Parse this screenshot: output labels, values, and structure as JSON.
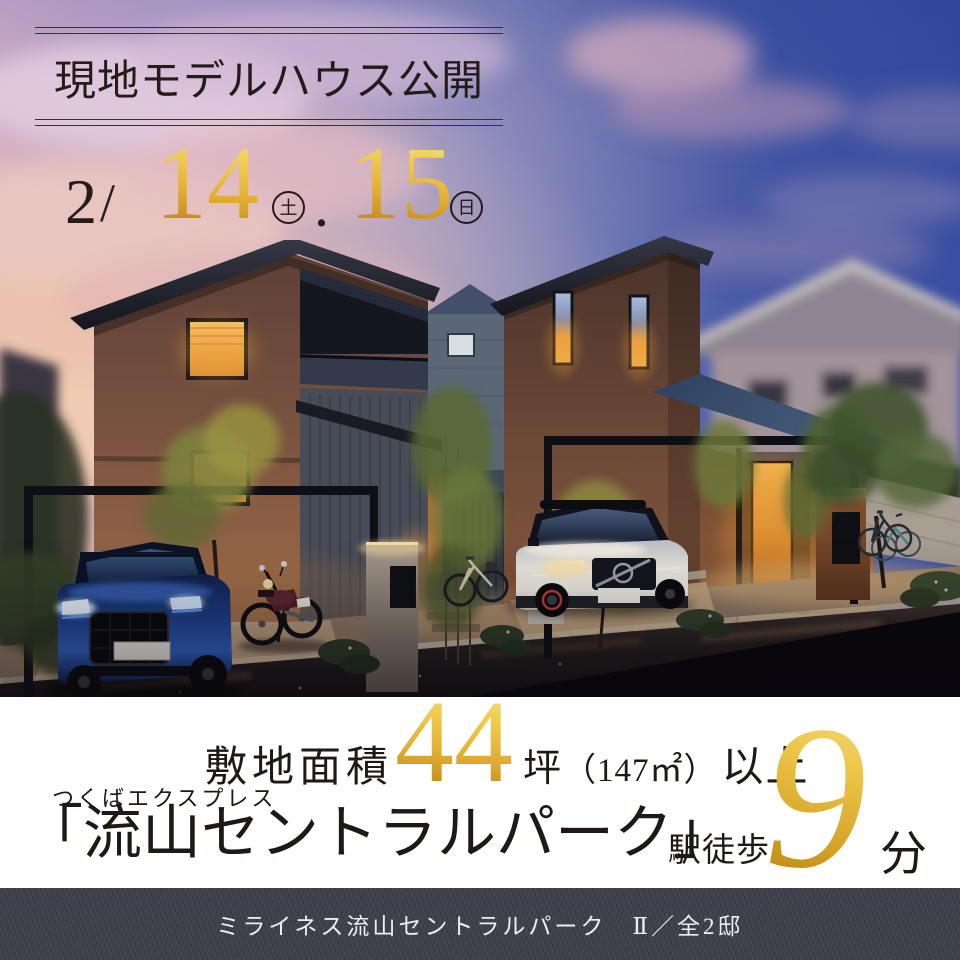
{
  "poster": {
    "header": {
      "title": "現地モデルハウス公開"
    },
    "dates": {
      "month": "2",
      "slash": "/",
      "day1": "14",
      "day1_dow": "土",
      "dot": ".",
      "day2": "15",
      "day2_dow": "日"
    },
    "photo": {
      "alt": "夕暮れのモデルハウス2棟の外観CG。手前の道路沿いに青いSUV、白いSUV、バイク、自転車、植栽と門柱が並ぶ。"
    },
    "site_area": {
      "label": "敷地面積",
      "value": "44",
      "unit": "坪",
      "detail": "（147㎡）",
      "suffix": "以上"
    },
    "access": {
      "rail_line": "つくばエクスプレス",
      "station": "「流山セントラルパーク」",
      "walk_label": "駅徒歩",
      "minutes": "9",
      "minutes_unit": "分"
    },
    "footer": {
      "project": "ミライネス流山セントラルパーク　Ⅱ／全2邸"
    },
    "colors": {
      "gold_light": "#f5df7a",
      "gold_mid": "#e4b636",
      "gold_deep": "#b8830e",
      "ink": "#241c18",
      "white_band": "#ffffff",
      "footer_bg": "#3f404b",
      "footer_text": "#edeef2"
    }
  }
}
